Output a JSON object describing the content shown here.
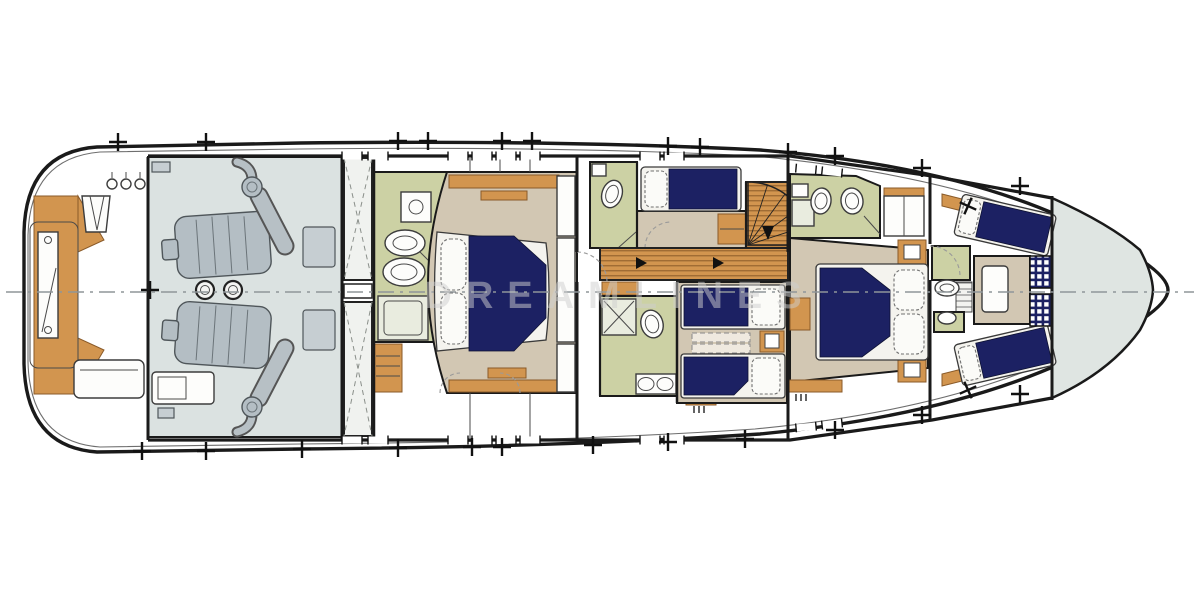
{
  "diagram": {
    "semantic_label": "Motor yacht lower deck general arrangement floor plan",
    "watermark": "DREAMLINES"
  },
  "rooms": {
    "swim_platform": "Swim platform and tender garage",
    "lazarette": "Lazarette",
    "engine_room": "Engine room",
    "tanks": "Fuel tank space",
    "master_head": "Master bathroom",
    "master_cabin": "Master cabin",
    "day_head": "Guest bathroom",
    "single_cabin": "Single guest cabin",
    "staircase": "Staircase",
    "corridor": "Companionway corridor",
    "shower_head": "Guest shower room",
    "twin_cabin": "Twin guest cabin",
    "vip_head": "VIP bathroom",
    "vip_cabin": "VIP cabin",
    "crew_quarters": "Crew quarters",
    "crew_head": "Crew head",
    "forepeak": "Forepeak chain locker"
  },
  "palette": {
    "hull_line": "#1a1a1a",
    "engine_room_floor": "#dbe2e1",
    "machinery_gray": "#b4bec4",
    "machinery_dark": "#4f565a",
    "bathroom_green": "#ccd1a4",
    "cabin_beige": "#d2c7b3",
    "bed_navy": "#1c2163",
    "wood_orange": "#d2954f",
    "wood_dark": "#8a5a28",
    "mattress_white": "#f4f3ee",
    "forepeak_gray": "#dfe5e2",
    "centerline_gray": "#8f9699",
    "watermark_gray": "#cfcfcf"
  }
}
